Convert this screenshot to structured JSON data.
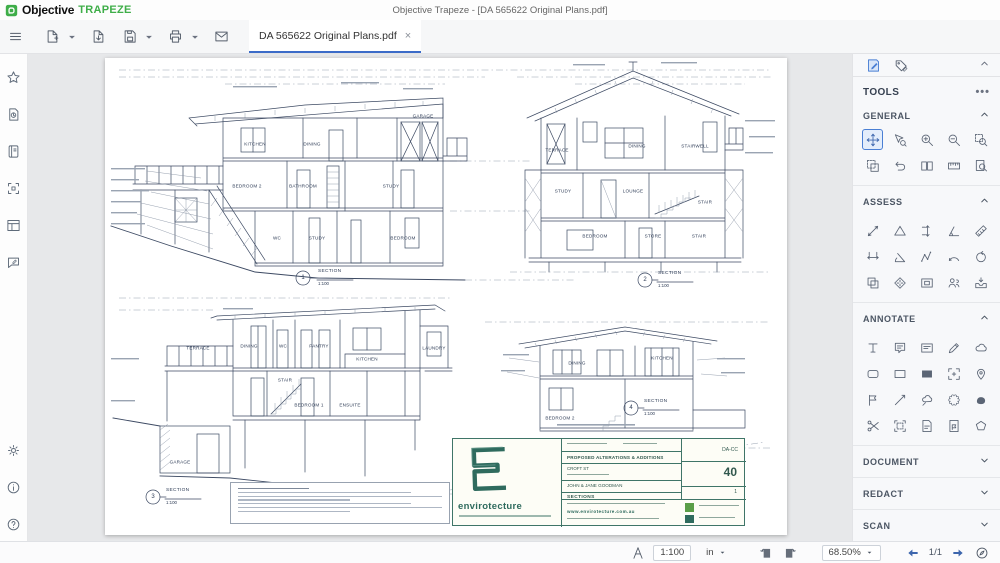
{
  "window": {
    "title": "Objective Trapeze - [DA 565622 Original Plans.pdf]"
  },
  "brand": {
    "name": "Objective",
    "product": "TRAPEZE"
  },
  "toolbar": {
    "tab_label": "DA 565622 Original Plans.pdf",
    "tab_close": "×"
  },
  "status_bar": {
    "scale": "1:100",
    "unit": "in",
    "zoom": "68.50%",
    "page": "1/1"
  },
  "tools_panel": {
    "title": "TOOLS",
    "menu_dots": "•••",
    "sections": [
      {
        "label": "GENERAL",
        "expanded": true,
        "tools": [
          {
            "name": "pan",
            "icon": "move",
            "selected": true
          },
          {
            "name": "select-zoom",
            "icon": "cursorzoom"
          },
          {
            "name": "zoom-in",
            "icon": "zoomin"
          },
          {
            "name": "zoom-out",
            "icon": "zoomout"
          },
          {
            "name": "zoom-area",
            "icon": "zoomarea"
          },
          {
            "name": "snapshot",
            "icon": "snapshot"
          },
          {
            "name": "undo",
            "icon": "undo"
          },
          {
            "name": "facing-pages",
            "icon": "pages"
          },
          {
            "name": "actual-size",
            "icon": "ruler100"
          },
          {
            "name": "page-search",
            "icon": "pagesearch"
          }
        ]
      },
      {
        "label": "ASSESS",
        "expanded": true,
        "tools": [
          {
            "name": "measure-length",
            "icon": "mline"
          },
          {
            "name": "measure-area",
            "icon": "mtri"
          },
          {
            "name": "measure-vertical",
            "icon": "mvert"
          },
          {
            "name": "measure-angle",
            "icon": "mang"
          },
          {
            "name": "scale-ruler",
            "icon": "mruler"
          },
          {
            "name": "measure-horizontal",
            "icon": "mhoriz"
          },
          {
            "name": "measure-perpendicular",
            "icon": "mang2"
          },
          {
            "name": "measure-polyline",
            "icon": "mpath"
          },
          {
            "name": "measure-arc",
            "icon": "marc"
          },
          {
            "name": "measure-circle",
            "icon": "mcirc"
          },
          {
            "name": "compare-documents",
            "icon": "compare"
          },
          {
            "name": "calibrate",
            "icon": "target"
          },
          {
            "name": "overlay-pages",
            "icon": "overlay"
          },
          {
            "name": "assign-reviewer",
            "icon": "people"
          },
          {
            "name": "submit-review",
            "icon": "tray"
          }
        ]
      },
      {
        "label": "ANNOTATE",
        "expanded": true,
        "tools": [
          {
            "name": "typewriter",
            "icon": "txt"
          },
          {
            "name": "sticky-note",
            "icon": "note"
          },
          {
            "name": "text-box",
            "icon": "textbox"
          },
          {
            "name": "pencil",
            "icon": "pen"
          },
          {
            "name": "cloud",
            "icon": "cloud"
          },
          {
            "name": "rounded-rectangle",
            "icon": "rect2"
          },
          {
            "name": "rectangle",
            "icon": "rect"
          },
          {
            "name": "filled-rectangle",
            "icon": "rectf"
          },
          {
            "name": "stamp-frame",
            "icon": "framearrows"
          },
          {
            "name": "pin",
            "icon": "pin"
          },
          {
            "name": "flag",
            "icon": "flag"
          },
          {
            "name": "polyline",
            "icon": "line45"
          },
          {
            "name": "cloud-callout",
            "icon": "cloudp"
          },
          {
            "name": "revision-cloud",
            "icon": "cloud2"
          },
          {
            "name": "freehand-highlight",
            "icon": "blob"
          },
          {
            "name": "cut-region",
            "icon": "cut"
          },
          {
            "name": "select-annotations",
            "icon": "docsel"
          },
          {
            "name": "attach-note",
            "icon": "docnote"
          },
          {
            "name": "document-flag",
            "icon": "docflag"
          },
          {
            "name": "polygon",
            "icon": "poly"
          }
        ]
      },
      {
        "label": "DOCUMENT",
        "expanded": false
      },
      {
        "label": "REDACT",
        "expanded": false
      },
      {
        "label": "SCAN",
        "expanded": false
      }
    ]
  },
  "document": {
    "sections": [
      {
        "num": "1",
        "label": "SECTION",
        "scale": "1:100",
        "rooms": [
          "KITCHEN",
          "DINING",
          "GARAGE",
          "BEDROOM 2",
          "BATHROOM",
          "STUDY",
          "WC",
          "STUDY",
          "BEDROOM"
        ]
      },
      {
        "num": "2",
        "label": "SECTION",
        "scale": "1:100",
        "rooms": [
          "TERRACE",
          "DINING",
          "STAIRWELL",
          "STUDY",
          "LOUNGE",
          "STAIR",
          "BEDROOM",
          "STORE",
          "STAIR"
        ]
      },
      {
        "num": "3",
        "label": "SECTION",
        "scale": "1:100",
        "rooms": [
          "TERRACE",
          "DINING",
          "WC",
          "PANTRY",
          "KITCHEN",
          "LAUNDRY",
          "STAIR",
          "BEDROOM 1",
          "ENSUITE",
          "GARAGE"
        ]
      },
      {
        "num": "4",
        "label": "SECTION",
        "scale": "1:100",
        "rooms": [
          "DINING",
          "KITCHEN",
          "BEDROOM 2"
        ]
      }
    ],
    "title_block": {
      "firm": "envirotecture",
      "project": "PROPOSED ALTERATIONS & ADDITIONS",
      "address": "CROFT ST",
      "client": "JOHN & JANE GOODMAN",
      "sheet": "SECTIONS",
      "stage": "DA-CC",
      "sheet_no": "40",
      "revision": "1",
      "website": "www.envirotecture.com.au"
    }
  }
}
